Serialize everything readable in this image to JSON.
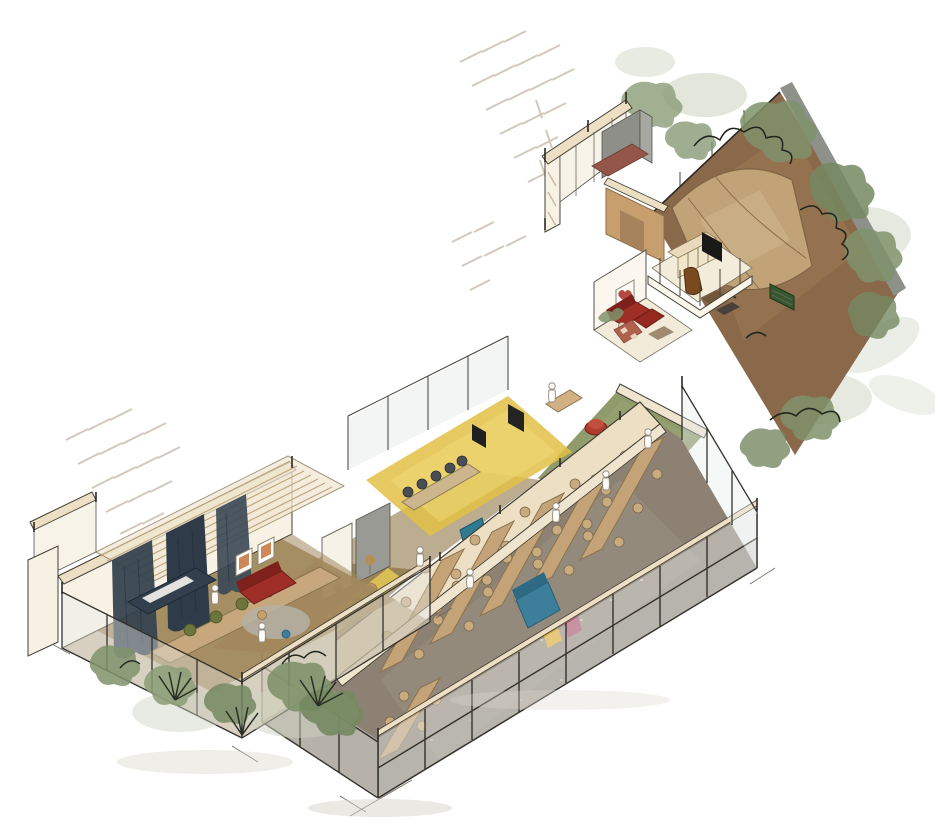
{
  "scene": {
    "type": "axonometric-interior-sketch",
    "style": "hand-drawn watercolor architectural cutaway",
    "rooms": [
      "activity-room",
      "lounge-corridor",
      "meeting-room",
      "office-nooks",
      "dining-hall",
      "green-hall",
      "family-lounge",
      "tv-room",
      "service-rooms",
      "garden-terrace"
    ],
    "people_count": 9,
    "dining_tables_count": 6
  },
  "palette": {
    "paper": "#ffffff",
    "sketch_line": "#3a372e",
    "wall_face": "#f8f2e5",
    "wall_cap": "#eddfc4",
    "wood_trim": "#d5ba8e",
    "act_floor": "#a2885c",
    "lounge_floor": "#8f7446",
    "curtain_navy": "#36434f",
    "stage_navy": "#32404d",
    "table_wood": "#c4a376",
    "chair_tan": "#c9ab80",
    "chair_olive": "#6b753d",
    "chair_dark": "#4a4e52",
    "sofa_red": "#9e2e26",
    "rug_grey": "#b5b1a6",
    "frame_orange": "#c06a33",
    "din_floor": "#8c8173",
    "sofa_blue": "#3d7e9a",
    "accent_yellow": "#e3ae25",
    "accent_magenta": "#ab4965",
    "meet_floor": "#e2bf45",
    "booth_teal": "#2f7d93",
    "door_red": "#a03828",
    "hall_green": "#87935f",
    "pouf_red": "#b03a2c",
    "garden_ground": "#8a684a",
    "canopy_tan": "#c2a277",
    "bench_green": "#35582f",
    "foliage_light": "#c6cdb8",
    "foliage_mid": "#7f926b",
    "foliage_dark": "#20251d",
    "stone_grey": "#8e918a",
    "stall_grey": "#8f8f8a",
    "brick_red": "#95564a",
    "closet_tan": "#c79f6f",
    "tv_black": "#191917",
    "glass": "#e8ecea",
    "hatch": "#c8bcaa",
    "shadow": "#d8d4c9",
    "person": "#fdfcf8"
  }
}
